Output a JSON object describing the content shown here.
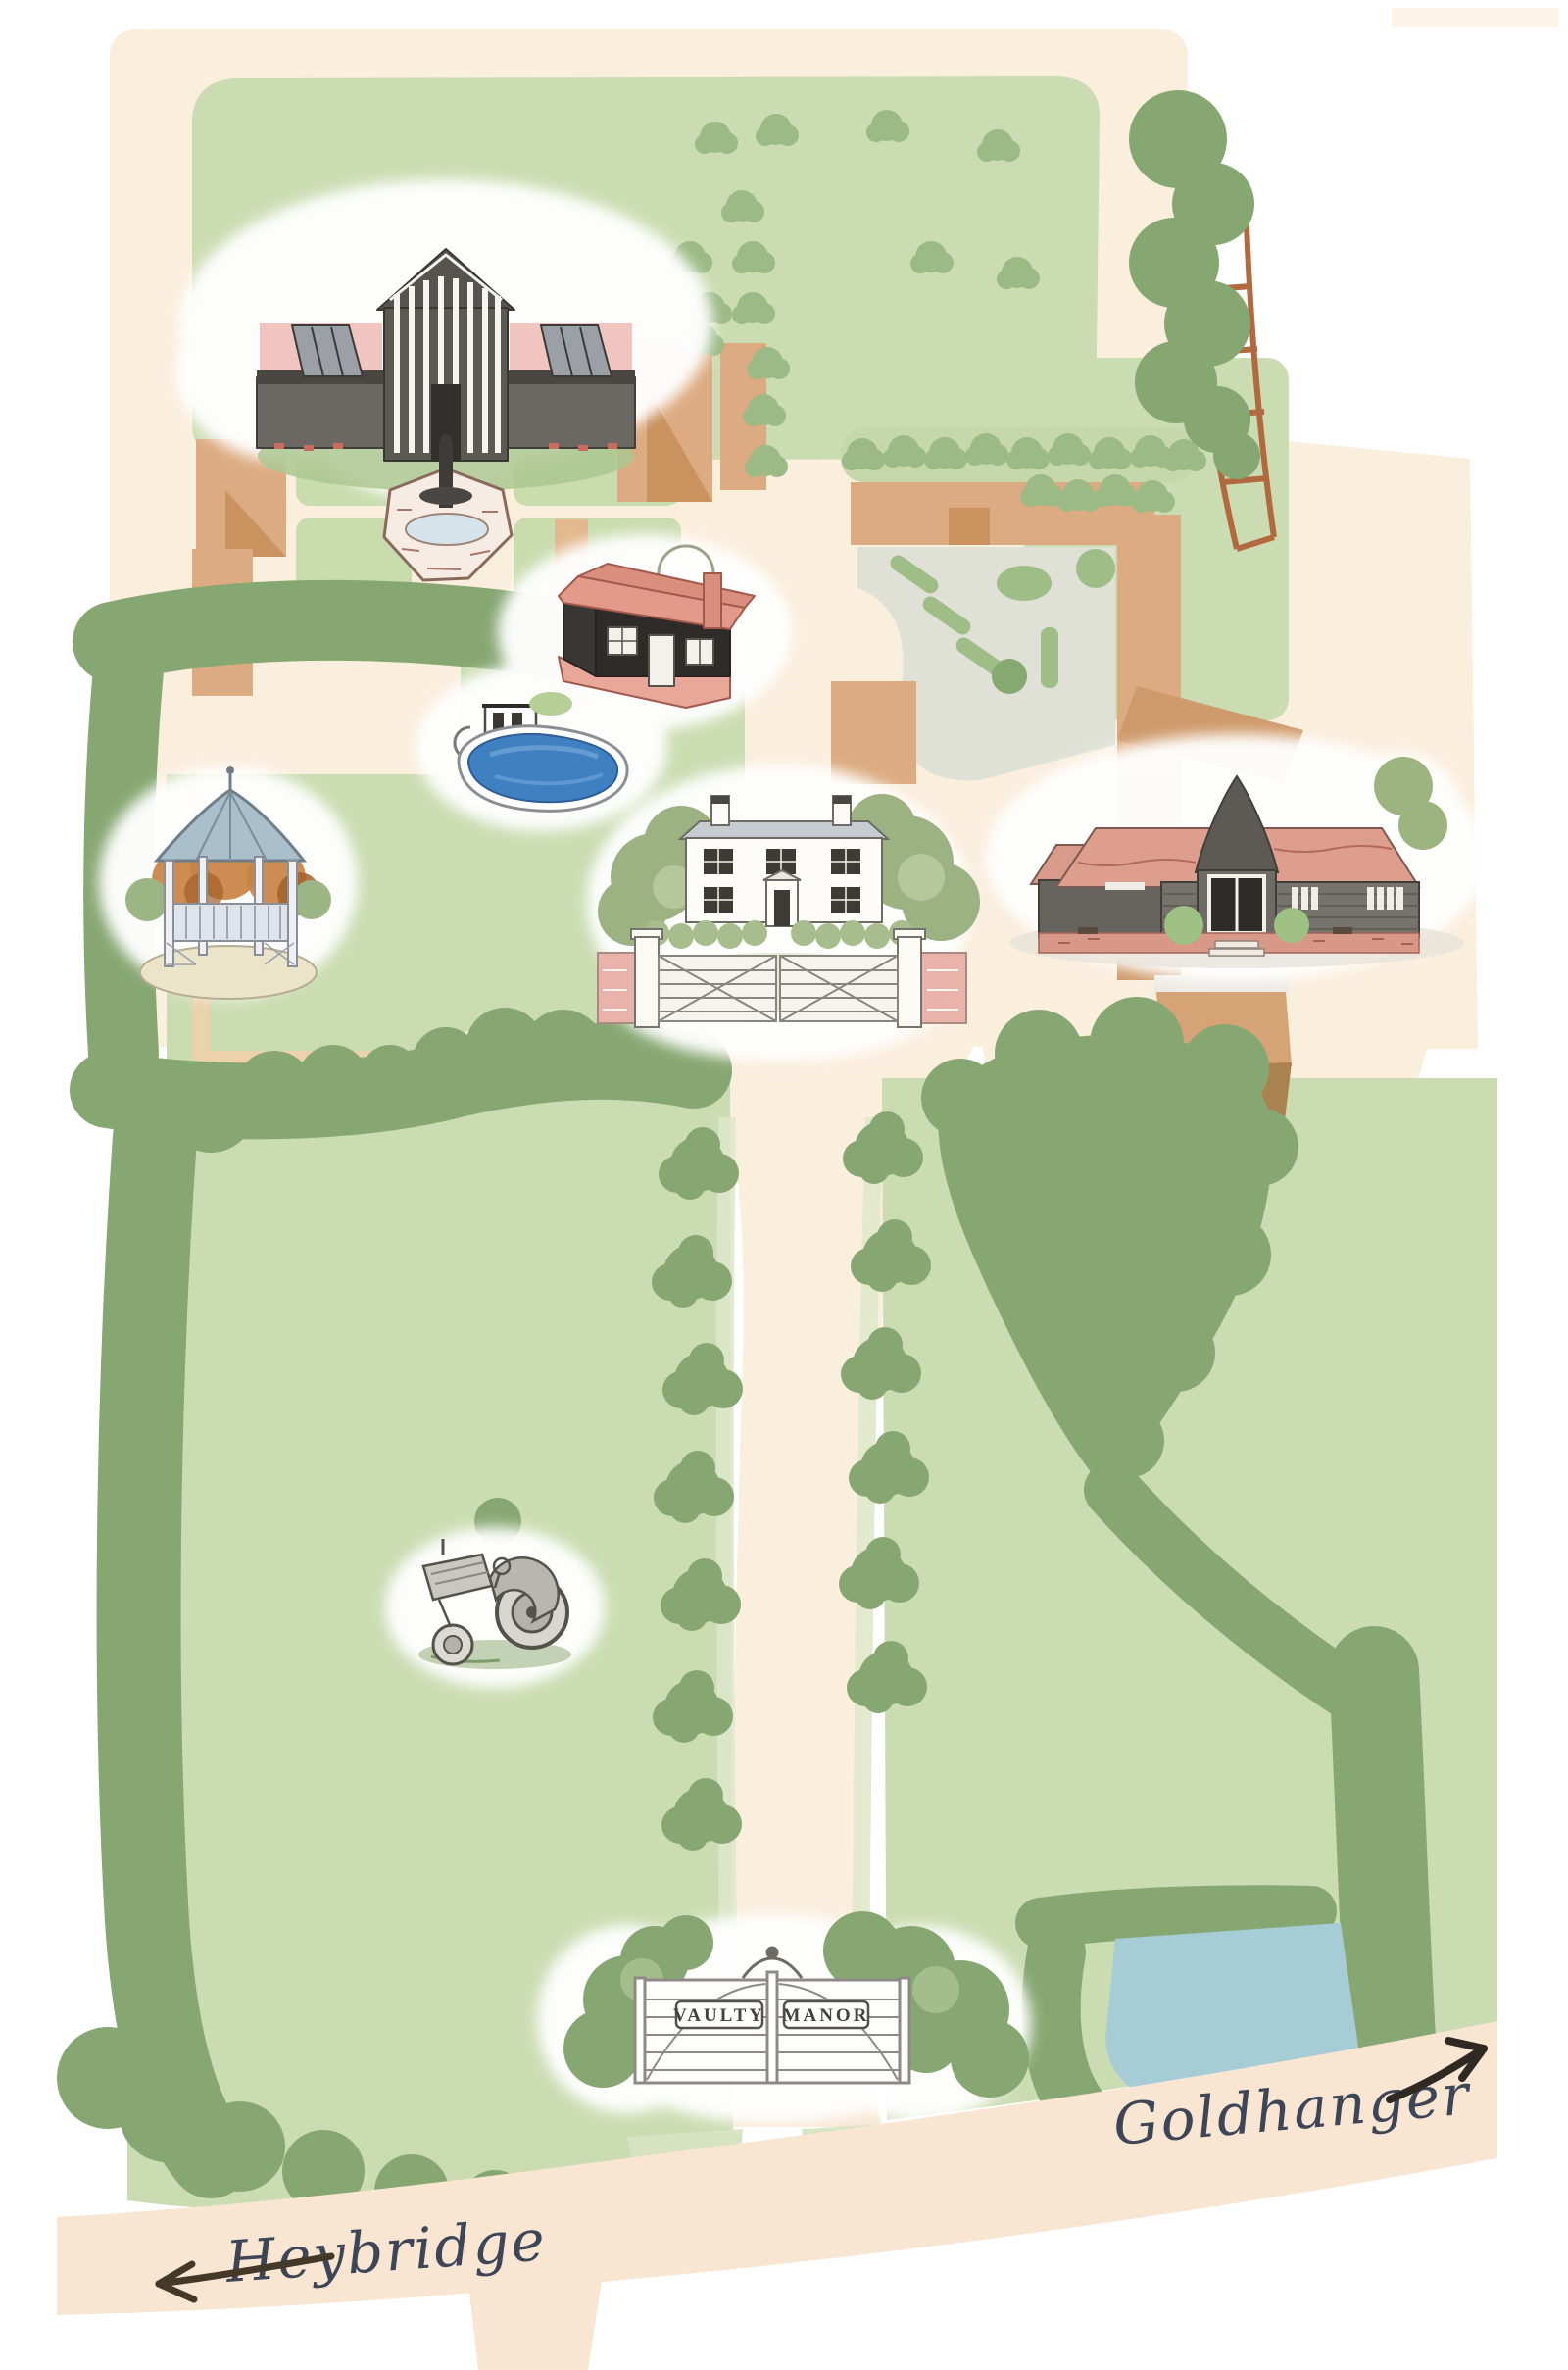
{
  "map": {
    "labels": {
      "heybridge": "Heybridge",
      "goldhanger": "Goldhanger"
    },
    "gate_sign": {
      "left": "VAULTY",
      "right": "MANOR"
    },
    "landmark_icons": [
      "great-barn-with-fountain-illustration",
      "black-barn-illustration",
      "swimming-pool-illustration",
      "garden-gazebo-illustration",
      "manor-house-and-gates-illustration",
      "reception-barn-illustration",
      "vintage-tractor-illustration",
      "entrance-gates-illustration",
      "ornamental-pond",
      "lake",
      "field-fence"
    ],
    "palette": {
      "paper": "#ffffff",
      "cream": "#faeedd",
      "road": "#f8e6d3",
      "field_light": "#cbdcb2",
      "field_pale": "#d8e3c2",
      "garden_quadrant": "#c9dcae",
      "tree_dark": "#87a772",
      "tree_mid": "#9cba85",
      "building_tan": "#dcab81",
      "building_tan_shade": "#c9925f",
      "building_brown": "#a9824f",
      "courtyard_grey": "#dfe0d6",
      "pond_small_blue": "#74b9e2",
      "pool_blue": "#3f80c2",
      "lake_blue": "#a6ccd6",
      "fence_red": "#b2693f",
      "script_ink": "#3d4557",
      "arrow_brown": "#443928",
      "roof_pink": "#f0c5bf",
      "roof_salmon": "#dd9e8e",
      "barn_dark": "#5c5852"
    }
  }
}
